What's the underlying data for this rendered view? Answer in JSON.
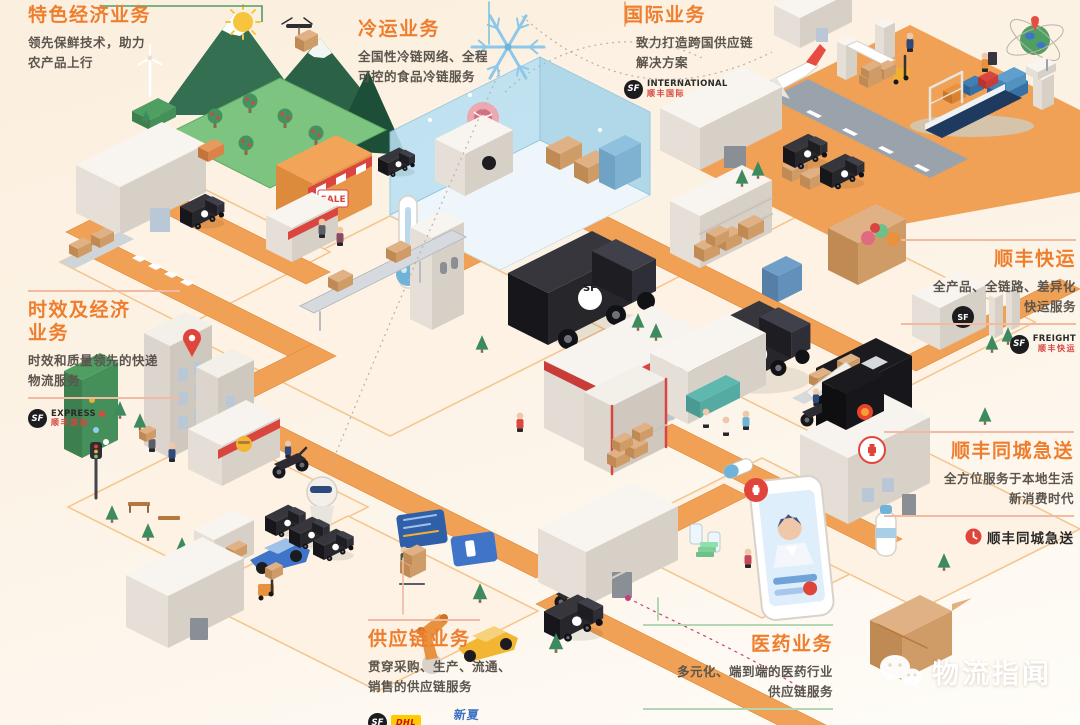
{
  "colors": {
    "accent_orange": "#ee7e2e",
    "text_dark": "#5b554e",
    "road_orange": "#f0a156",
    "cold_blue": "#a9d6ec",
    "green": "#3f8e63",
    "red": "#d9453f"
  },
  "labels": {
    "fresh": {
      "title": "特色经济业务",
      "d1": "领先保鲜技术，助力",
      "d2": "农产品上行"
    },
    "cold": {
      "title": "冷运业务",
      "d1": "全国性冷链网络、全程",
      "d2": "可控的食品冷链服务"
    },
    "intl": {
      "title": "国际业务",
      "d1": "致力打造跨国供应链",
      "d2": "解决方案",
      "logo_en": "INTERNATIONAL",
      "logo_cn": "顺丰国际"
    },
    "express": {
      "t1": "时效及经济",
      "t2": "业务",
      "d1": "时效和质量领先的快递",
      "d2": "物流服务",
      "logo_en": "EXPRESS",
      "logo_cn": "顺丰速运"
    },
    "freight": {
      "title": "顺丰快运",
      "d1": "全产品、全链路、差异化",
      "d2": "快运服务",
      "logo_en": "FREIGHT",
      "logo_cn": "顺丰快运"
    },
    "intracity": {
      "title": "顺丰同城急送",
      "d1": "全方位服务于本地生活",
      "d2": "新消费时代",
      "logo_text": "顺丰同城急送"
    },
    "supply": {
      "title": "供应链业务",
      "d1": "贯穿采购、生产、流通、",
      "d2": "销售的供应链服务",
      "logo_dhl": "DHL",
      "logo_partner": "新夏晖"
    },
    "pharma": {
      "title": "医药业务",
      "d1": "多元化、端到端的医药行业",
      "d2": "供应链服务"
    }
  },
  "logos": {
    "sf": "SF"
  },
  "scene_texts": {
    "sale": "SALE",
    "sf": "SF"
  },
  "watermark": {
    "text": "物流指闻"
  }
}
